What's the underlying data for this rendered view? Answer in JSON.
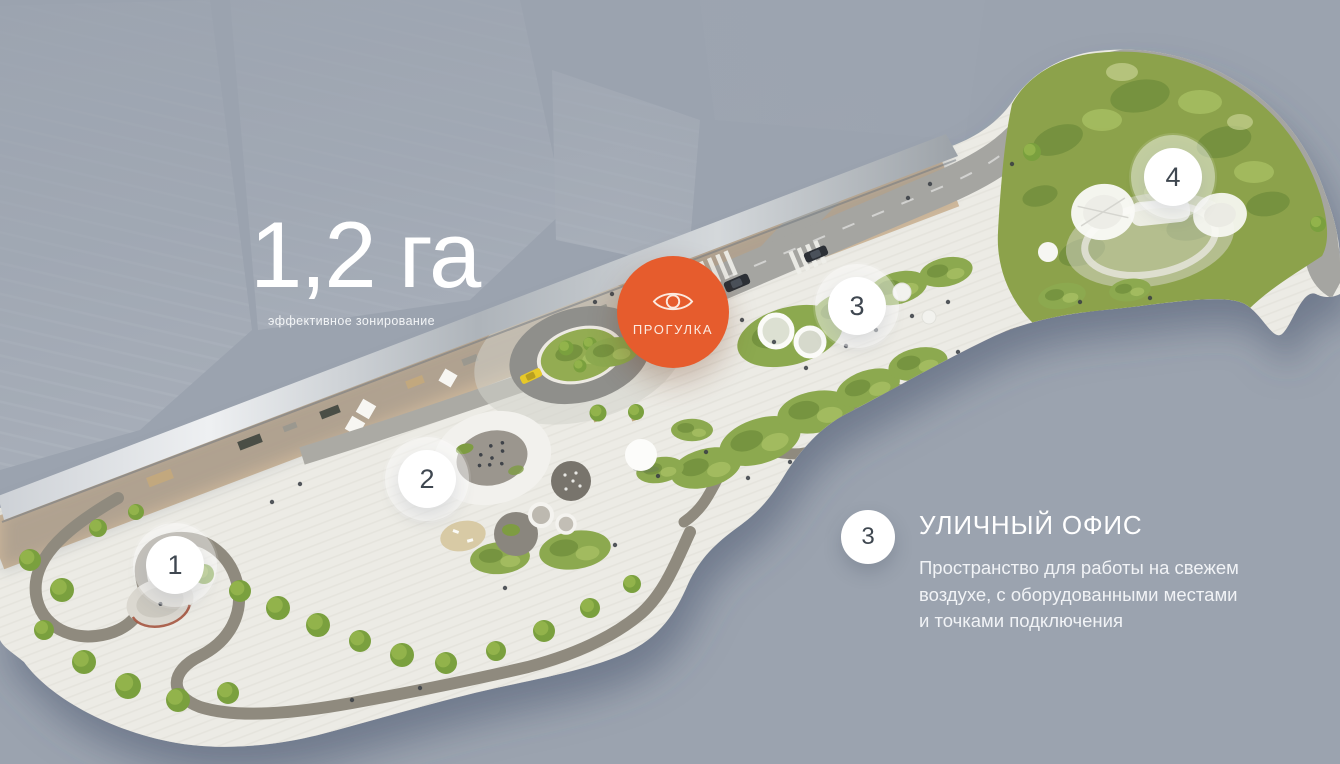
{
  "colors": {
    "background": "#9BA3AF",
    "accent_orange": "#E65C2D",
    "marker_number_text": "#3F4750",
    "plaza_paving": "#ECEBE5",
    "greenery": "#8CA94F"
  },
  "stat": {
    "value": "1,2 га",
    "label": "эффективное зонирование"
  },
  "tour_button": {
    "label": "ПРОГУЛКА",
    "icon": "eye-icon"
  },
  "markers": [
    {
      "number": "1"
    },
    {
      "number": "2"
    },
    {
      "number": "3"
    },
    {
      "number": "4"
    }
  ],
  "legend": {
    "number": "3",
    "title": "УЛИЧНЫЙ ОФИС",
    "description_lines": [
      "Пространство для работы на свежем",
      "воздухе, с оборудованными местами",
      "и точками подключения"
    ]
  }
}
